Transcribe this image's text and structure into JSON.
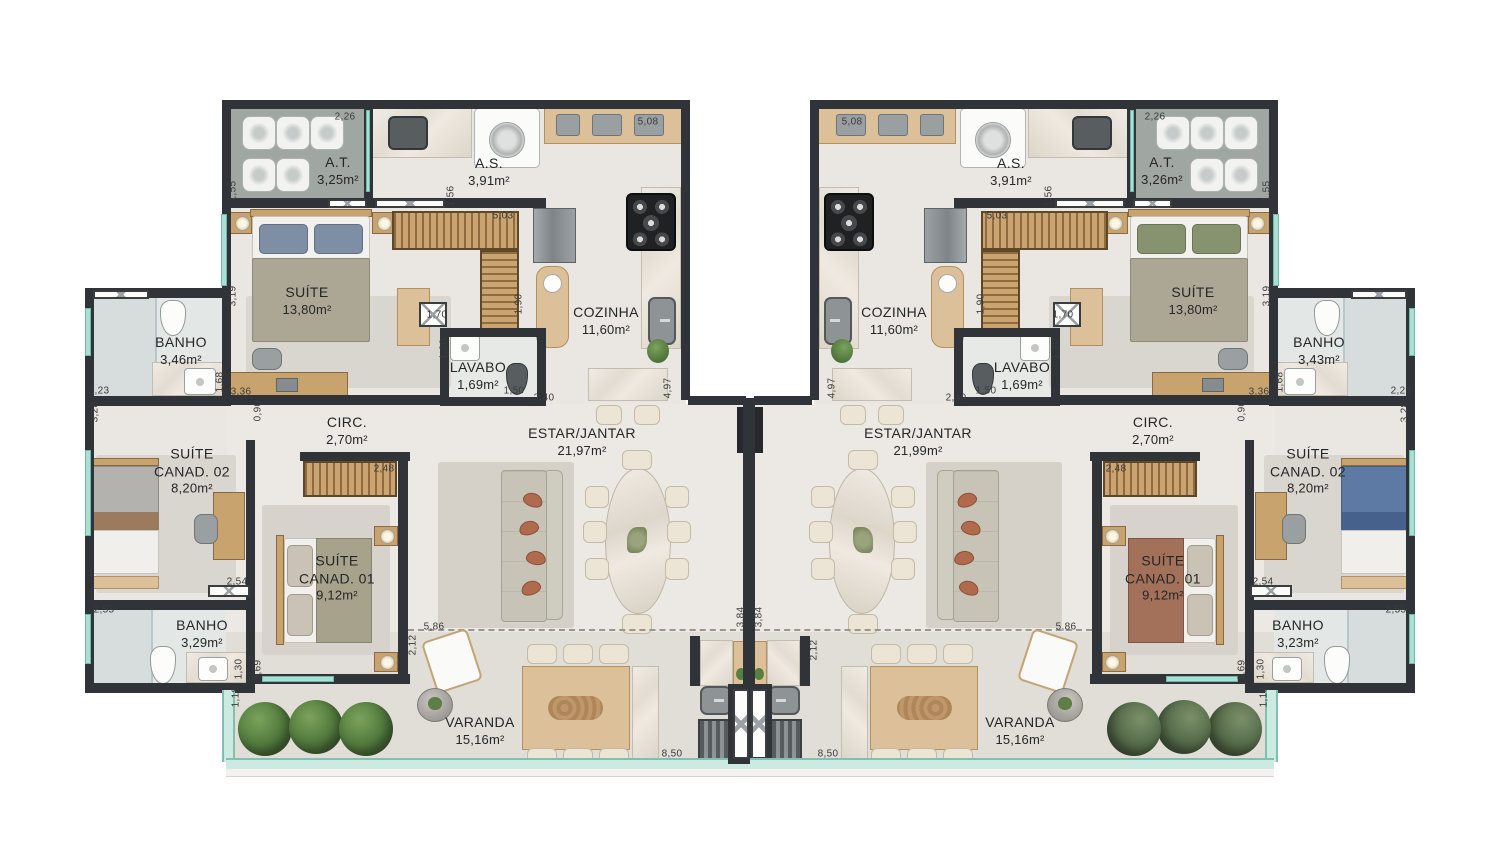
{
  "plan": {
    "type": "residential-floor-plan-two-units",
    "colors": {
      "wall": "#303338",
      "floor_top": "#eae7e2",
      "floor_mid": "#ece9e4",
      "floor_varanda": "#e1ddd7",
      "floor_bath_tile": "#e3e7e6",
      "floor_at_gray": "#a0a7a3",
      "wood": "#c8a36e",
      "glass_teal": "#abdfd4",
      "marble": "#efeae3",
      "plant_green_left": "#567f40",
      "plant_green_right": "#5a6b50",
      "accent_rust": "#b06a4e"
    },
    "units": {
      "left": {
        "label": "unit-left",
        "rooms": [
          {
            "id": "at",
            "name": "A.T.",
            "area": "3,25m²",
            "x": 338,
            "y": 171
          },
          {
            "id": "as",
            "name": "A.S.",
            "area": "3,91m²",
            "x": 489,
            "y": 172
          },
          {
            "id": "suite",
            "name": "SUÍTE",
            "area": "13,80m²",
            "x": 307,
            "y": 301
          },
          {
            "id": "cozinha",
            "name": "COZINHA",
            "area": "11,60m²",
            "x": 606,
            "y": 321
          },
          {
            "id": "lavabo",
            "name": "LAVABO",
            "area": "1,69m²",
            "x": 478,
            "y": 376
          },
          {
            "id": "banho-suite",
            "name": "BANHO",
            "area": "3,46m²",
            "x": 181,
            "y": 351
          },
          {
            "id": "circ",
            "name": "CIRC.",
            "area": "2,70m²",
            "x": 347,
            "y": 431
          },
          {
            "id": "estar-jantar",
            "name": "ESTAR/JANTAR",
            "area": "21,97m²",
            "x": 582,
            "y": 442
          },
          {
            "id": "suite-canad-02",
            "name": "SUÍTE\nCANAD. 02",
            "area": "8,20m²",
            "x": 192,
            "y": 471
          },
          {
            "id": "suite-canad-01",
            "name": "SUÍTE\nCANAD. 01",
            "area": "9,12m²",
            "x": 337,
            "y": 578
          },
          {
            "id": "banho-canad",
            "name": "BANHO",
            "area": "3,29m²",
            "x": 202,
            "y": 634
          },
          {
            "id": "varanda",
            "name": "VARANDA",
            "area": "15,16m²",
            "x": 480,
            "y": 731
          }
        ]
      },
      "right": {
        "label": "unit-right",
        "rooms": [
          {
            "id": "at",
            "name": "A.T.",
            "area": "3,26m²",
            "x": 1162,
            "y": 171
          },
          {
            "id": "as",
            "name": "A.S.",
            "area": "3,91m²",
            "x": 1011,
            "y": 172
          },
          {
            "id": "suite",
            "name": "SUÍTE",
            "area": "13,80m²",
            "x": 1193,
            "y": 301
          },
          {
            "id": "cozinha",
            "name": "COZINHA",
            "area": "11,60m²",
            "x": 894,
            "y": 321
          },
          {
            "id": "lavabo",
            "name": "LAVABO",
            "area": "1,69m²",
            "x": 1022,
            "y": 376
          },
          {
            "id": "banho-suite",
            "name": "BANHO",
            "area": "3,43m²",
            "x": 1319,
            "y": 351
          },
          {
            "id": "circ",
            "name": "CIRC.",
            "area": "2,70m²",
            "x": 1153,
            "y": 431
          },
          {
            "id": "estar-jantar",
            "name": "ESTAR/JANTAR",
            "area": "21,99m²",
            "x": 918,
            "y": 442
          },
          {
            "id": "suite-canad-02",
            "name": "SUÍTE\nCANAD. 02",
            "area": "8,20m²",
            "x": 1308,
            "y": 471
          },
          {
            "id": "suite-canad-01",
            "name": "SUÍTE\nCANAD. 01",
            "area": "9,12m²",
            "x": 1163,
            "y": 578
          },
          {
            "id": "banho-canad",
            "name": "BANHO",
            "area": "3,23m²",
            "x": 1298,
            "y": 634
          },
          {
            "id": "varanda",
            "name": "VARANDA",
            "area": "15,16m²",
            "x": 1020,
            "y": 731
          }
        ]
      }
    },
    "dimensions": [
      {
        "v": "2,26",
        "x": 345,
        "y": 117,
        "o": "h",
        "m": true
      },
      {
        "v": "5,08",
        "x": 648,
        "y": 122,
        "o": "h",
        "m": true
      },
      {
        "v": "1,55",
        "x": 233,
        "y": 191,
        "o": "v",
        "m": true
      },
      {
        "v": "1,56",
        "x": 451,
        "y": 196,
        "o": "v",
        "m": true
      },
      {
        "v": "3,19",
        "x": 233,
        "y": 296,
        "o": "v",
        "m": true
      },
      {
        "v": "5,03",
        "x": 503,
        "y": 216,
        "o": "h",
        "m": true
      },
      {
        "v": "1,70",
        "x": 437,
        "y": 315,
        "o": "h",
        "m": true
      },
      {
        "v": "1,90",
        "x": 519,
        "y": 304,
        "o": "v",
        "m": true
      },
      {
        "v": "1,20",
        "x": 444,
        "y": 349,
        "o": "v",
        "m": true
      },
      {
        "v": "1,50",
        "x": 514,
        "y": 391,
        "o": "h",
        "m": true
      },
      {
        "v": "2,40",
        "x": 544,
        "y": 398,
        "o": "h",
        "m": true
      },
      {
        "v": "4,97",
        "x": 668,
        "y": 388,
        "o": "v",
        "m": true
      },
      {
        "v": "2,23",
        "x": 99,
        "y": 391,
        "o": "h",
        "m": true
      },
      {
        "v": "1,68",
        "x": 220,
        "y": 382,
        "o": "v",
        "m": true
      },
      {
        "v": "3,36",
        "x": 241,
        "y": 392,
        "o": "h",
        "m": true
      },
      {
        "v": "0,90",
        "x": 258,
        "y": 411,
        "o": "v",
        "m": true
      },
      {
        "v": "3,28",
        "x": 95,
        "y": 412,
        "o": "v",
        "m": true
      },
      {
        "v": "2,48",
        "x": 384,
        "y": 469,
        "o": "h",
        "m": true
      },
      {
        "v": "2,54",
        "x": 237,
        "y": 582,
        "o": "h",
        "m": true
      },
      {
        "v": "2,55",
        "x": 104,
        "y": 610,
        "o": "h",
        "m": true
      },
      {
        "v": "1,30",
        "x": 239,
        "y": 669,
        "o": "v",
        "m": true
      },
      {
        "v": "3,69",
        "x": 258,
        "y": 670,
        "o": "v",
        "m": true
      },
      {
        "v": "1,18",
        "x": 236,
        "y": 697,
        "o": "v",
        "m": true
      },
      {
        "v": "5,86",
        "x": 434,
        "y": 627,
        "o": "h",
        "m": true
      },
      {
        "v": "8,50",
        "x": 672,
        "y": 754,
        "o": "h",
        "m": true
      },
      {
        "v": "3,84",
        "x": 741,
        "y": 617,
        "o": "v",
        "m": true
      },
      {
        "v": "2,12",
        "x": 413,
        "y": 645,
        "o": "v",
        "m": false
      },
      {
        "v": "2,12",
        "x": 814,
        "y": 650,
        "o": "v",
        "m": false
      }
    ]
  }
}
